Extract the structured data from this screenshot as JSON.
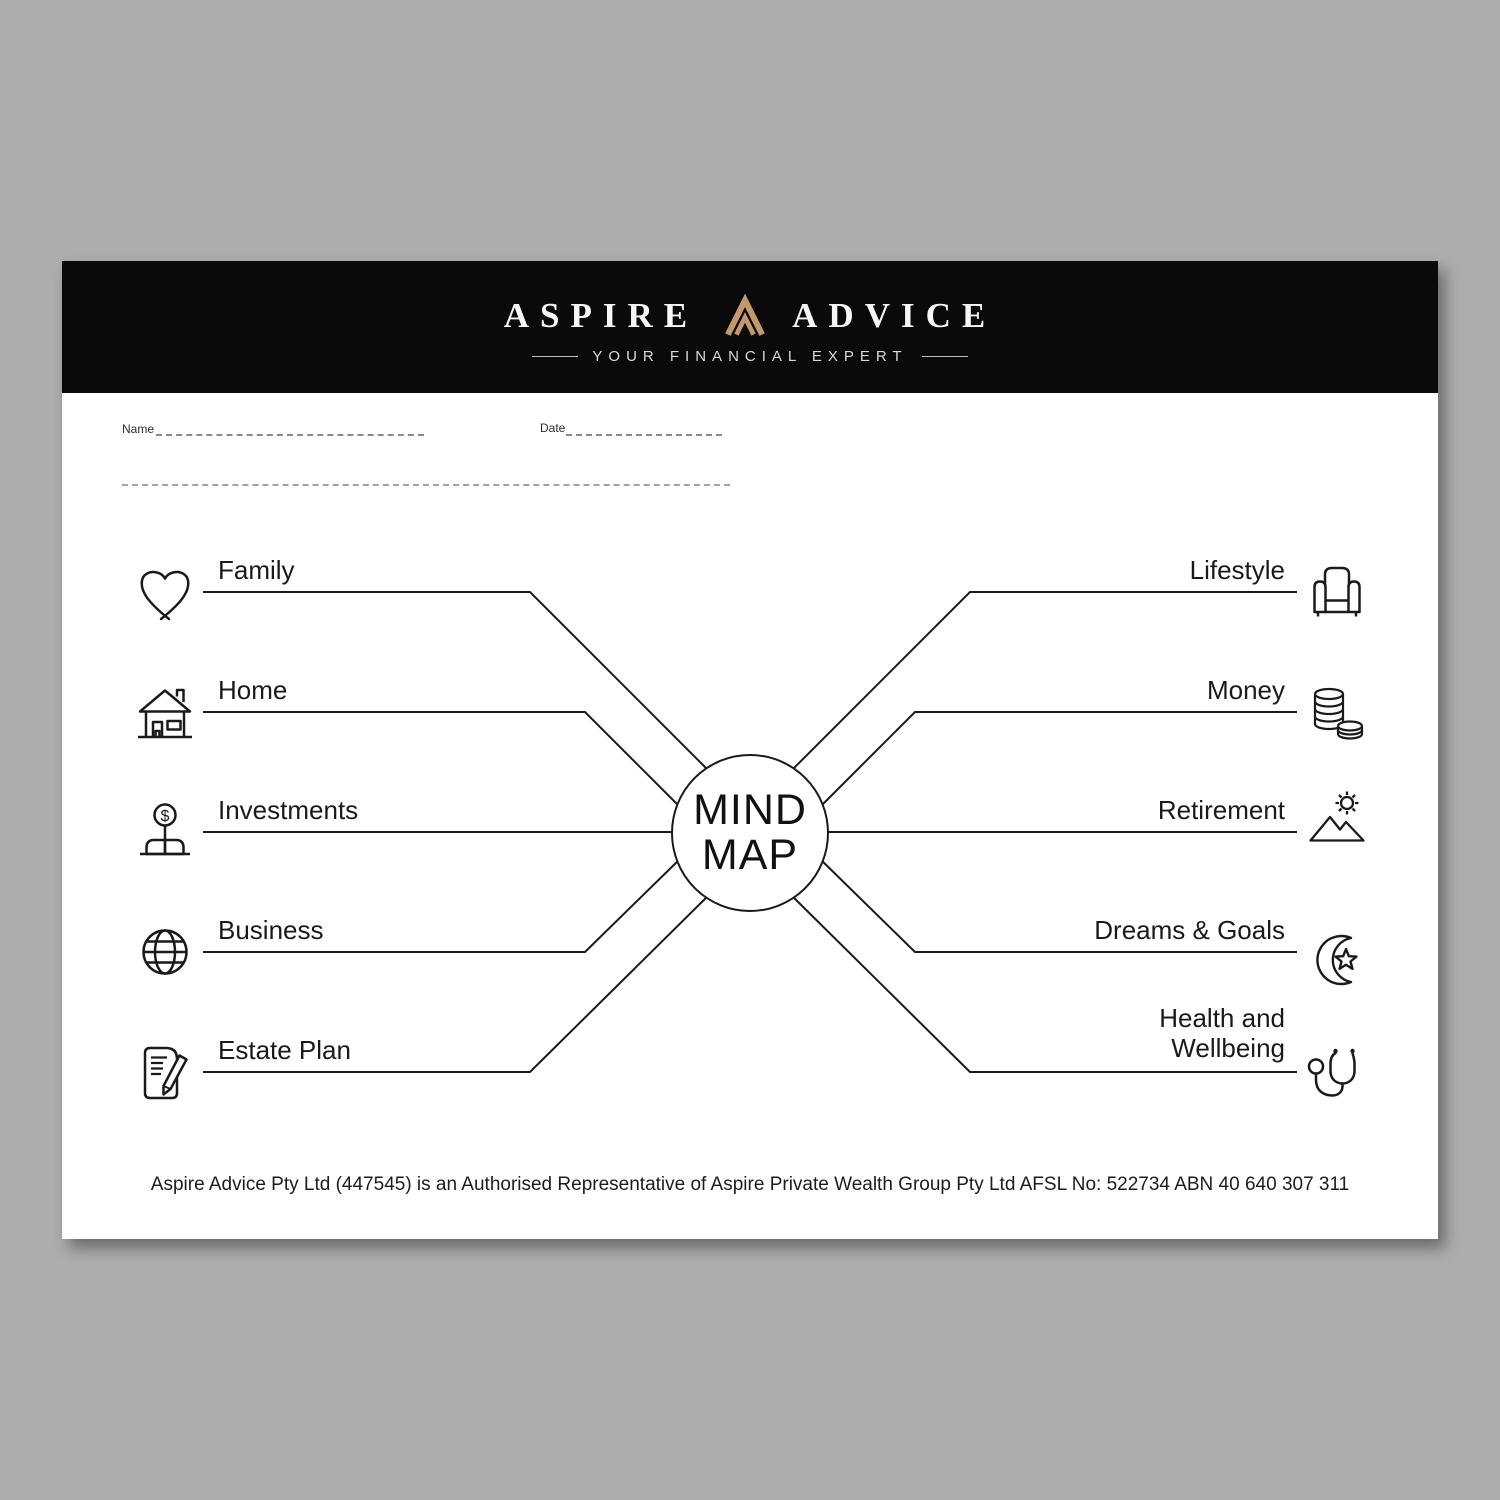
{
  "brand": {
    "word_left": "ASPIRE",
    "word_right": "ADVICE",
    "tagline": "YOUR FINANCIAL EXPERT"
  },
  "colors": {
    "brand_gold": "#c49a6c",
    "header_bg": "#0a0a0a",
    "line_ink": "#1a1a1a"
  },
  "form": {
    "name_label": "Name",
    "date_label": "Date"
  },
  "mindmap": {
    "center_line1": "MIND",
    "center_line2": "MAP",
    "left_items": [
      {
        "label": "Family",
        "icon": "heart-icon"
      },
      {
        "label": "Home",
        "icon": "house-icon"
      },
      {
        "label": "Investments",
        "icon": "money-plant-icon",
        "glyph": "$"
      },
      {
        "label": "Business",
        "icon": "globe-icon"
      },
      {
        "label": "Estate Plan",
        "icon": "document-pen-icon"
      }
    ],
    "right_items": [
      {
        "label": "Lifestyle",
        "icon": "armchair-icon"
      },
      {
        "label": "Money",
        "icon": "coins-icon"
      },
      {
        "label": "Retirement",
        "icon": "sun-mountains-icon"
      },
      {
        "label": "Dreams & Goals",
        "icon": "moon-star-icon"
      },
      {
        "label": "Health and Wellbeing",
        "icon": "stethoscope-icon"
      }
    ]
  },
  "footer": {
    "disclaimer": "Aspire Advice Pty Ltd (447545) is an Authorised Representative of Aspire Private Wealth Group Pty Ltd AFSL No: 522734 ABN 40 640 307 311"
  }
}
